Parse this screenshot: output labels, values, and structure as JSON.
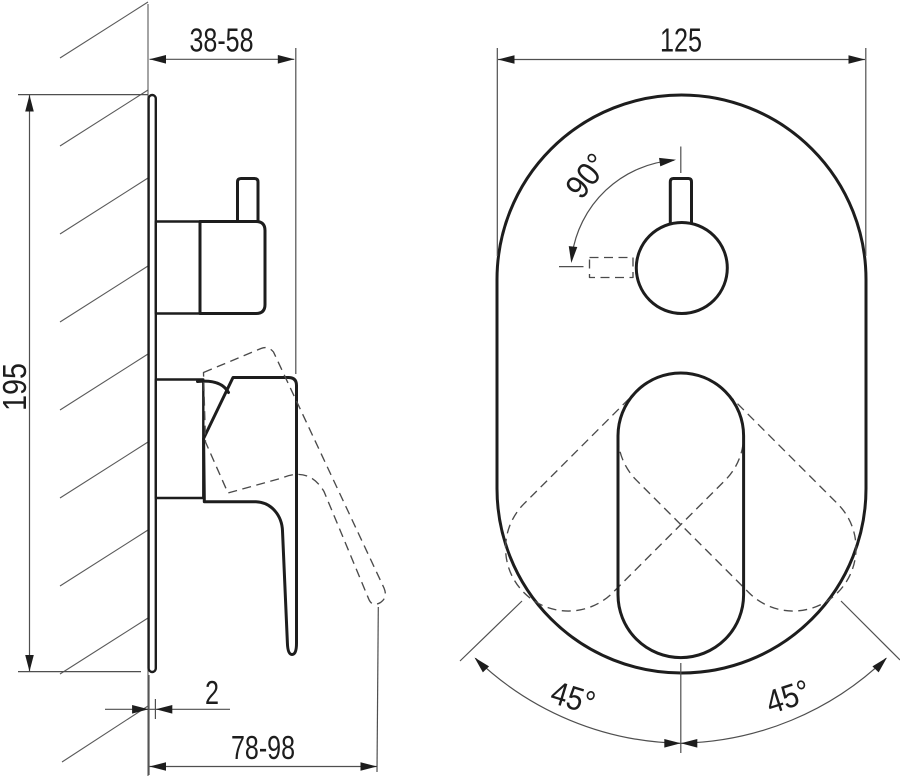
{
  "side_view": {
    "wall_offset": "38-58",
    "plate_height": "195",
    "plate_thickness": "2",
    "handle_depth": "78-98"
  },
  "front_view": {
    "plate_width": "125",
    "knob_rotation": "90°",
    "lever_swing_left": "45°",
    "lever_swing_right": "45°"
  }
}
